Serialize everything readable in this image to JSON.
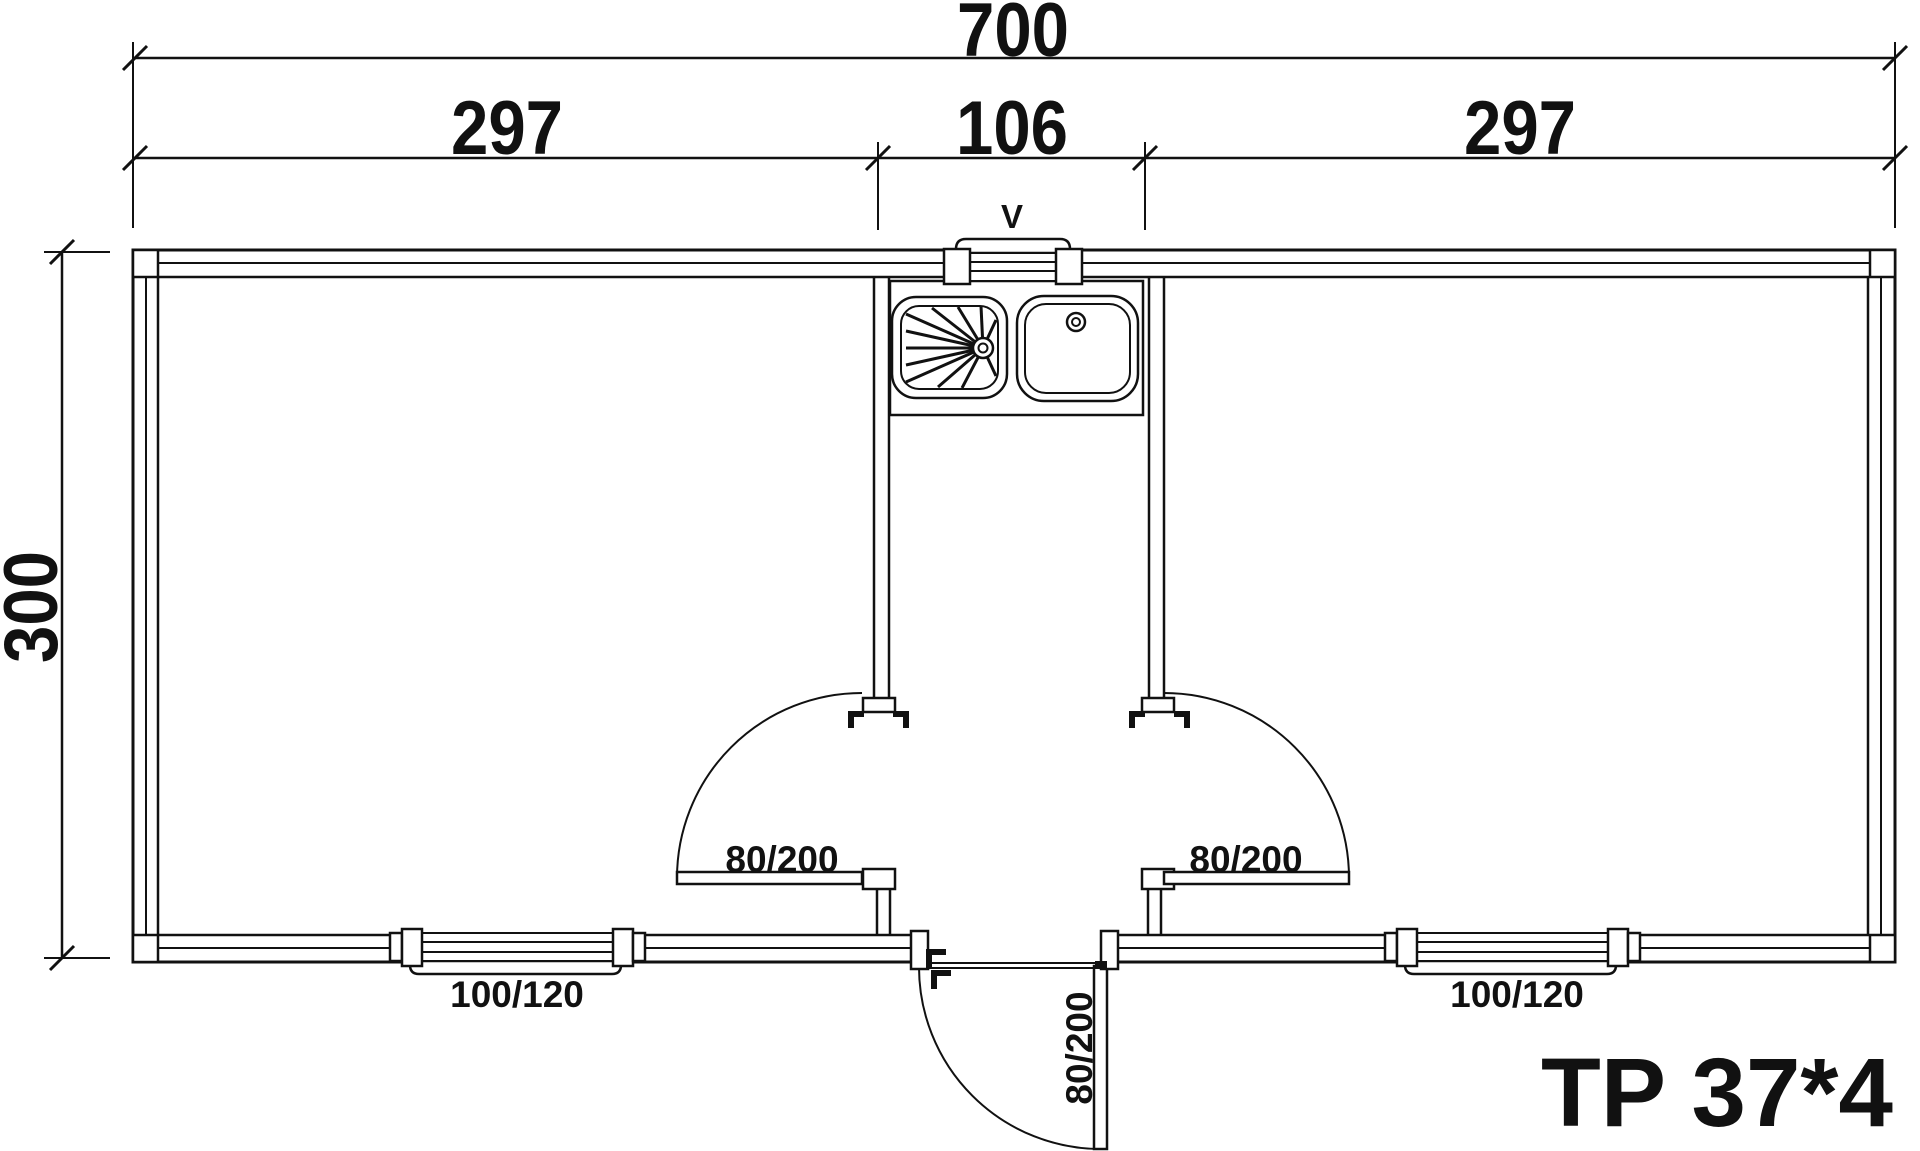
{
  "drawing": {
    "dimensions": {
      "overall_width": "700",
      "left_room_width": "297",
      "center_width": "106",
      "right_room_width": "297",
      "overall_depth": "300"
    },
    "labels": {
      "vent": "V",
      "door_left": "80/200",
      "door_right": "80/200",
      "door_entrance": "80/200",
      "window_left": "100/120",
      "window_right": "100/120",
      "model": "TP 37*4"
    },
    "colors": {
      "line": "#111111",
      "background": "#ffffff"
    }
  }
}
